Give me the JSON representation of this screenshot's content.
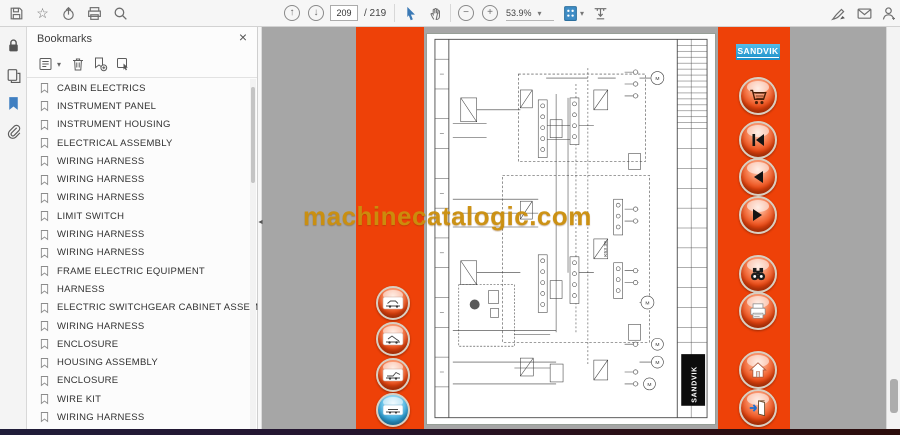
{
  "toolbar": {
    "page_current": "209",
    "page_total": "/ 219",
    "zoom_level": "53.9%"
  },
  "bookmarks_panel": {
    "title": "Bookmarks",
    "items": [
      "CABIN ELECTRICS",
      "INSTRUMENT PANEL",
      "INSTRUMENT HOUSING",
      "ELECTRICAL ASSEMBLY",
      "WIRING HARNESS",
      "WIRING HARNESS",
      "WIRING HARNESS",
      "LIMIT SWITCH",
      "WIRING HARNESS",
      "WIRING HARNESS",
      "FRAME ELECTRIC EQUIPMENT",
      "HARNESS",
      "ELECTRIC SWITCHGEAR CABINET ASSEMBLY",
      "WIRING HARNESS",
      "ENCLOSURE",
      "HOUSING ASSEMBLY",
      "ENCLOSURE",
      "WIRE KIT",
      "WIRING HARNESS"
    ]
  },
  "viewer": {
    "watermark": "machinecatalogic.com",
    "right_bar_logo": "SANDVIK"
  },
  "page": {
    "logo_vertical": "SANDVIK",
    "diagram_label": "K53.39"
  },
  "colors": {
    "accent_orange": "#ee4108",
    "sandvik_blue": "#29a8e0",
    "bookmark_blue": "#3f7fc1",
    "viewer_gray": "#a6a6a6"
  },
  "glyphs": {
    "close": "×",
    "caret": "▾",
    "up_arrow": "↑",
    "down_arrow": "↓",
    "minus": "−",
    "plus": "+",
    "back": "◀",
    "forward": "▶",
    "collapse": "◄",
    "star": "☆"
  }
}
